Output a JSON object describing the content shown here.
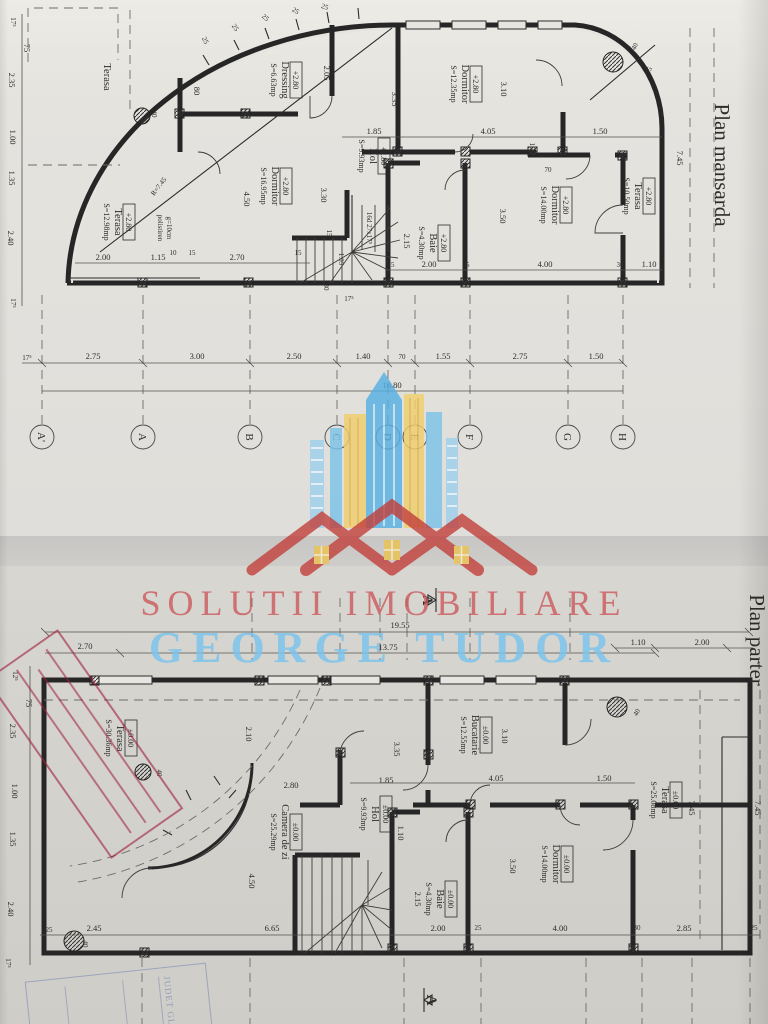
{
  "watermark": {
    "line1": "SOLUTII IMOBILIARE",
    "line2": "GEORGE TUDOR"
  },
  "m": {
    "title": "Plan mansarda",
    "level": "+2.80",
    "rooms": {
      "terasa_nw": {
        "name": "Terasa"
      },
      "dressing": {
        "name": "Dressing",
        "area": "S=6.63mp"
      },
      "dorm_vest": {
        "name": "Dormitor",
        "area": "S=16.95mp"
      },
      "terasa_sv": {
        "name": "Terasa",
        "area": "S=12.98mp"
      },
      "hol": {
        "name": "Hol",
        "area": "S=9.93mp"
      },
      "dorm_nord": {
        "name": "Dormitor",
        "area": "S=12.35mp"
      },
      "dorm_est": {
        "name": "Dormitor",
        "area": "S=14.00mp"
      },
      "baie": {
        "name": "Baie",
        "area": "S=4.30mp"
      },
      "terasa_est": {
        "name": "Terasa",
        "area": "S=10.50mp"
      }
    },
    "stair_note": "16d 27x17⁵",
    "insulation_note_1": "polistiren",
    "insulation_note_2": "g=10cm",
    "radius_label": "R=7.45",
    "dims": {
      "left": [
        "17⁵",
        "75",
        "2.35",
        "1.00",
        "1.35",
        "2.40",
        "17⁵"
      ],
      "curve": [
        "25",
        "25",
        "25",
        "25",
        "25",
        "40",
        "15"
      ],
      "upper": [
        "2.05",
        "80",
        "40",
        "3.35",
        "3.10"
      ],
      "mid": [
        "1.85",
        "4.05",
        "1.50",
        "15",
        "70"
      ],
      "inner": [
        "4.50",
        "3.30",
        "15",
        "1.05",
        "30",
        "2.15",
        "3.50",
        "7.45"
      ],
      "bottom1": [
        "2.00",
        "1.15",
        "10",
        "15",
        "2.70",
        "15",
        "17⁵"
      ],
      "bottom2": [
        "25",
        "2.00",
        "25",
        "4.00",
        "30",
        "1.10"
      ],
      "axis_row": [
        "17⁵",
        "2.75",
        "3.00",
        "2.50",
        "1.40",
        "70",
        "1.55",
        "2.75",
        "1.50"
      ],
      "total": "16.80"
    },
    "axes": [
      "A'",
      "A",
      "B",
      "C",
      "D",
      "E",
      "F",
      "G",
      "H"
    ]
  },
  "p": {
    "title": "Plan parter",
    "level": "±0.00",
    "rooms": {
      "terasa_vest": {
        "name": "Terasa",
        "area": "S=30.36mp"
      },
      "camera_zi": {
        "name": "Camera de zi",
        "area": "S=25.29mp"
      },
      "hol": {
        "name": "Hol",
        "area": "S=9.93mp"
      },
      "bucatarie": {
        "name": "Bucatarie",
        "area": "S=12.55mp"
      },
      "dorm": {
        "name": "Dormitor",
        "area": "S=14.00mp"
      },
      "baie": {
        "name": "Baie",
        "area": "S=4.30mp"
      },
      "terasa_est": {
        "name": "Terasa",
        "area": "S=25.08mp"
      }
    },
    "section_label": "A",
    "dims": {
      "top": [
        "19.55",
        "13.75",
        "2.70",
        "1.10",
        "2.00"
      ],
      "left": [
        "12⁵",
        "75",
        "2.35",
        "1.00",
        "1.35",
        "2.40",
        "17⁵"
      ],
      "inner": [
        "2.10",
        "3.35",
        "3.10",
        "1.10",
        "2.15",
        "3.50",
        "4.50",
        "7.45",
        "7.45"
      ],
      "mid": [
        "2.80",
        "1.85",
        "4.05",
        "1.50"
      ],
      "cols": [
        "40",
        "40",
        "40"
      ],
      "bottom": [
        "25",
        "2.45",
        "6.65",
        "2.00",
        "25",
        "4.00",
        "30",
        "2.85",
        "25"
      ]
    }
  },
  "stamps": {
    "blue_text": "JUDET GL"
  }
}
